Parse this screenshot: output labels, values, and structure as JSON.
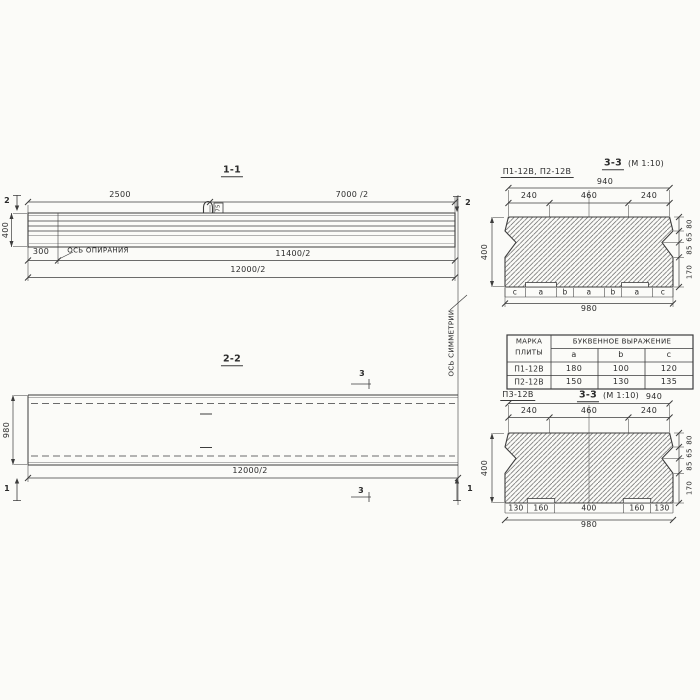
{
  "section_1_1": {
    "title": "1-1",
    "dim_2500": "2500",
    "dim_7000": "7000 /2",
    "marker_2_left": "2",
    "marker_2_right": "2",
    "height_400": "400",
    "dim_300": "300",
    "support_axis_label": "ОСЬ ОПИРАНИЯ",
    "dim_11400": "11400/2",
    "dim_12000": "12000/2",
    "loop_label": "75"
  },
  "section_2_2": {
    "title": "2-2",
    "marker_3_top": "3",
    "marker_3_bottom": "3",
    "marker_1_left": "1",
    "marker_1_right": "1",
    "height_980": "980",
    "dim_12000": "12000/2"
  },
  "symmetry_axis": {
    "label": "ОСЬ СИММЕТРИИ"
  },
  "section_33_top": {
    "plates_label": "П1-12В, П2-12В",
    "title": "3-3",
    "scale": "(М 1:10)",
    "dim_940": "940",
    "top_dims": [
      "240",
      "460",
      "240"
    ],
    "height_400": "400",
    "side_dims": [
      "80",
      "65",
      "85",
      "170"
    ],
    "letters": [
      "c",
      "a",
      "b",
      "a",
      "b",
      "a",
      "c"
    ],
    "dim_980": "980"
  },
  "plate_table": {
    "col_mark_line1": "МАРКА",
    "col_mark_line2": "ПЛИТЫ",
    "span_header": "БУКВЕННОЕ ВЫРАЖЕНИЕ",
    "letter_headers": [
      "a",
      "b",
      "c"
    ],
    "rows": [
      {
        "mark": "П1-12В",
        "a": "180",
        "b": "100",
        "c": "120"
      },
      {
        "mark": "П2-12В",
        "a": "150",
        "b": "130",
        "c": "135"
      }
    ]
  },
  "section_33_bottom": {
    "plate_label": "П3-12В",
    "title": "3-3",
    "scale": "(М 1:10)",
    "dim_940": "940",
    "top_dims": [
      "240",
      "460",
      "240"
    ],
    "height_400": "400",
    "side_dims": [
      "80",
      "65",
      "85",
      "170"
    ],
    "bottom_dims": [
      "130",
      "160",
      "400",
      "160",
      "130"
    ],
    "dim_980": "980"
  },
  "colors": {
    "line": "#3d3d3d",
    "text": "#2b2b2b",
    "background": "#fbfbf8"
  }
}
